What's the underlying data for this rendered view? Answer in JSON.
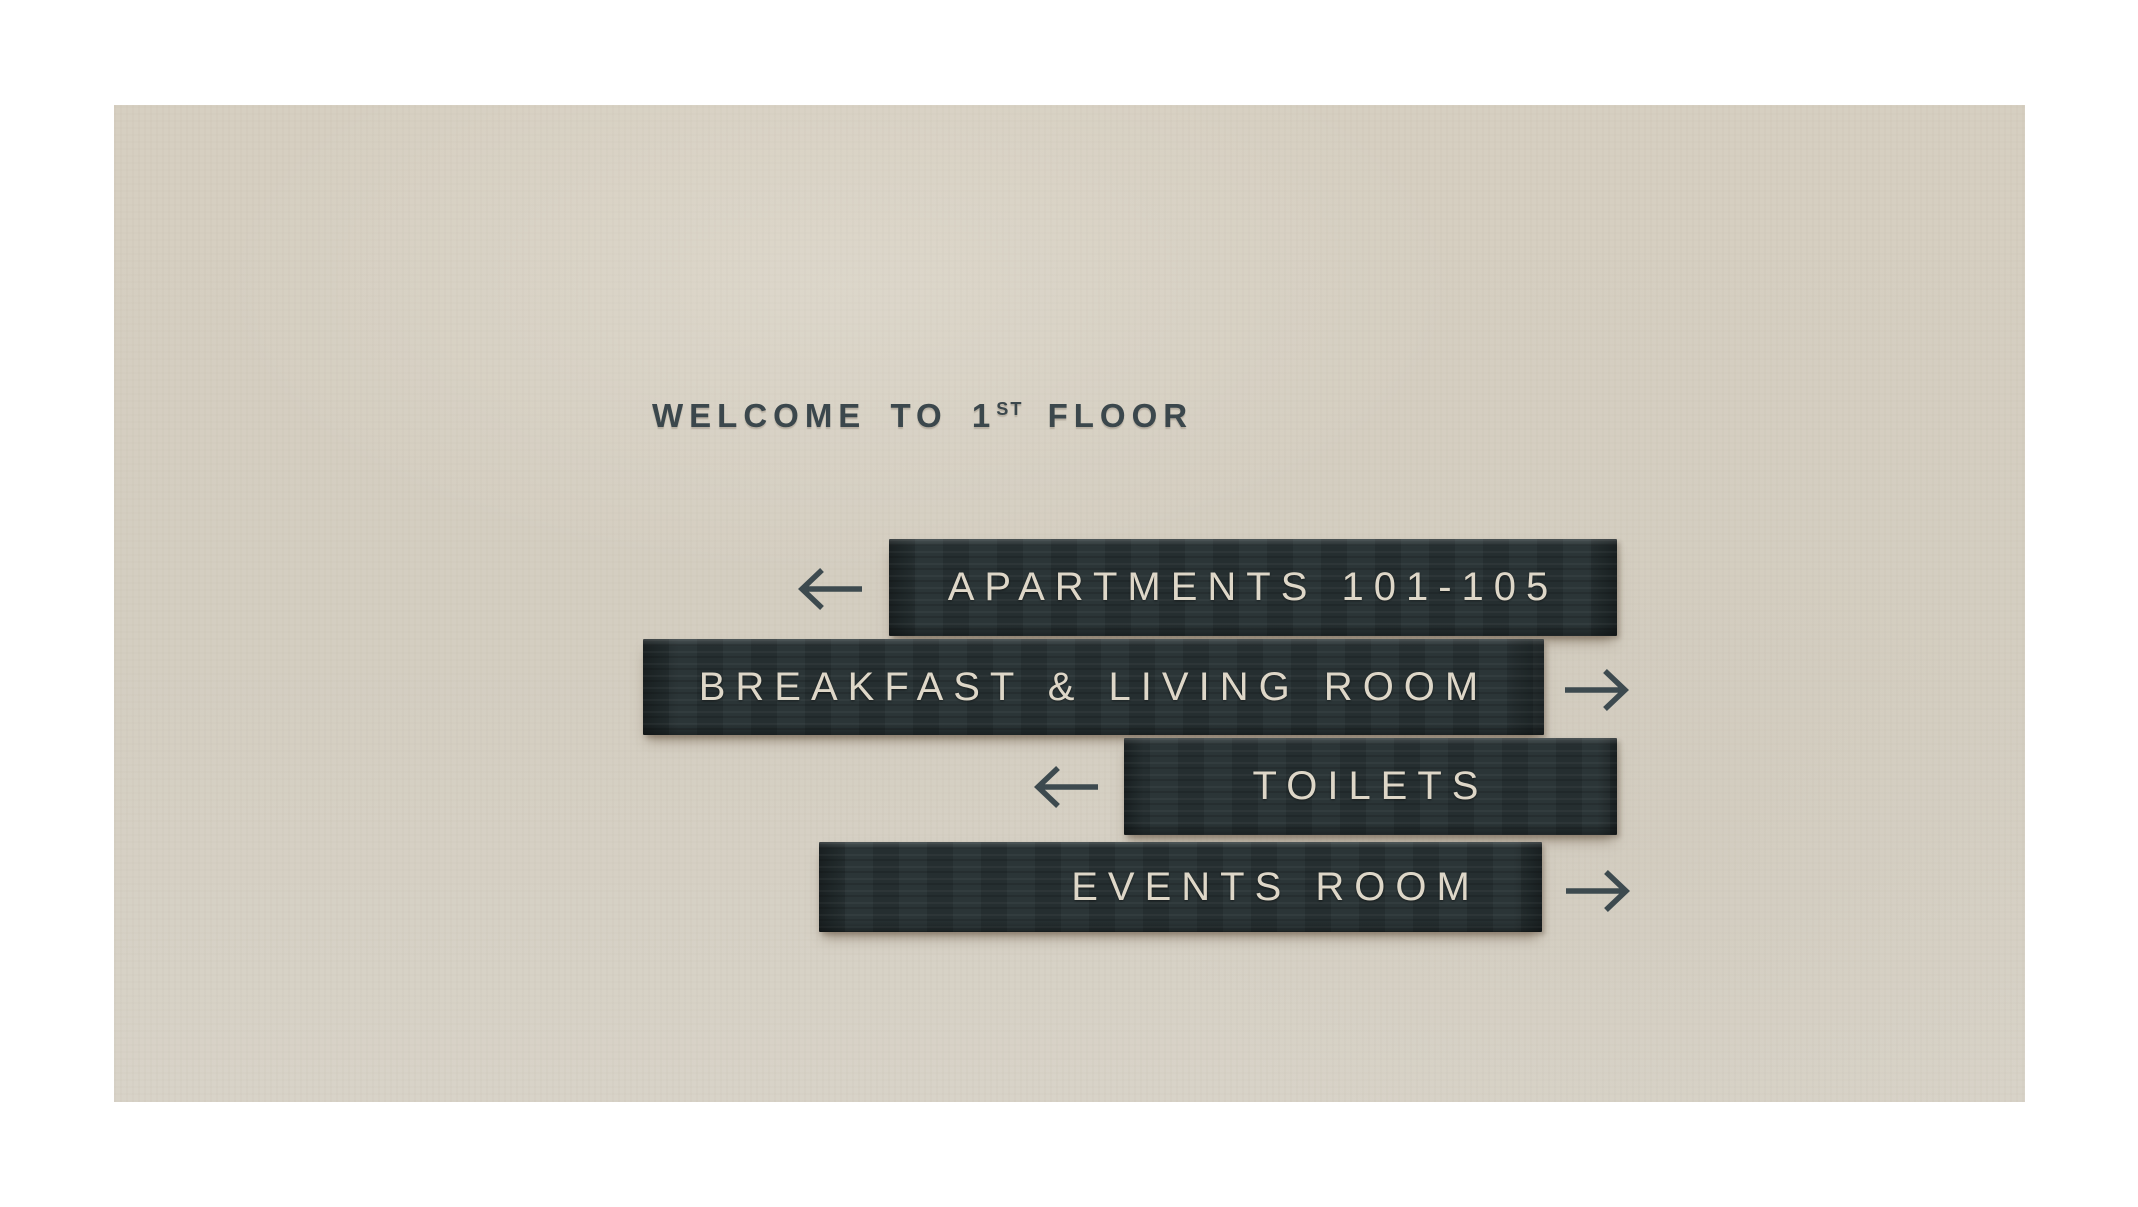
{
  "title": {
    "prefix": "WELCOME TO 1",
    "superscript": "ST",
    "suffix": " FLOOR"
  },
  "signs": [
    {
      "id": "apartments",
      "label": "APARTMENTS 101-105",
      "direction": "left",
      "icon": "arrow-left-icon"
    },
    {
      "id": "breakfast-living-room",
      "label": "BREAKFAST & LIVING ROOM",
      "direction": "right",
      "icon": "arrow-right-icon"
    },
    {
      "id": "toilets",
      "label": "TOILETS",
      "direction": "left",
      "icon": "arrow-left-icon"
    },
    {
      "id": "events-room",
      "label": "EVENTS ROOM",
      "direction": "right",
      "icon": "arrow-right-icon"
    }
  ],
  "colors": {
    "page_background": "#ffffff",
    "wall": "#d5cfc2",
    "bar": "#273133",
    "bar_text": "#ded7c8",
    "title_text": "#3b474c",
    "arrow": "#3d4a4f"
  }
}
